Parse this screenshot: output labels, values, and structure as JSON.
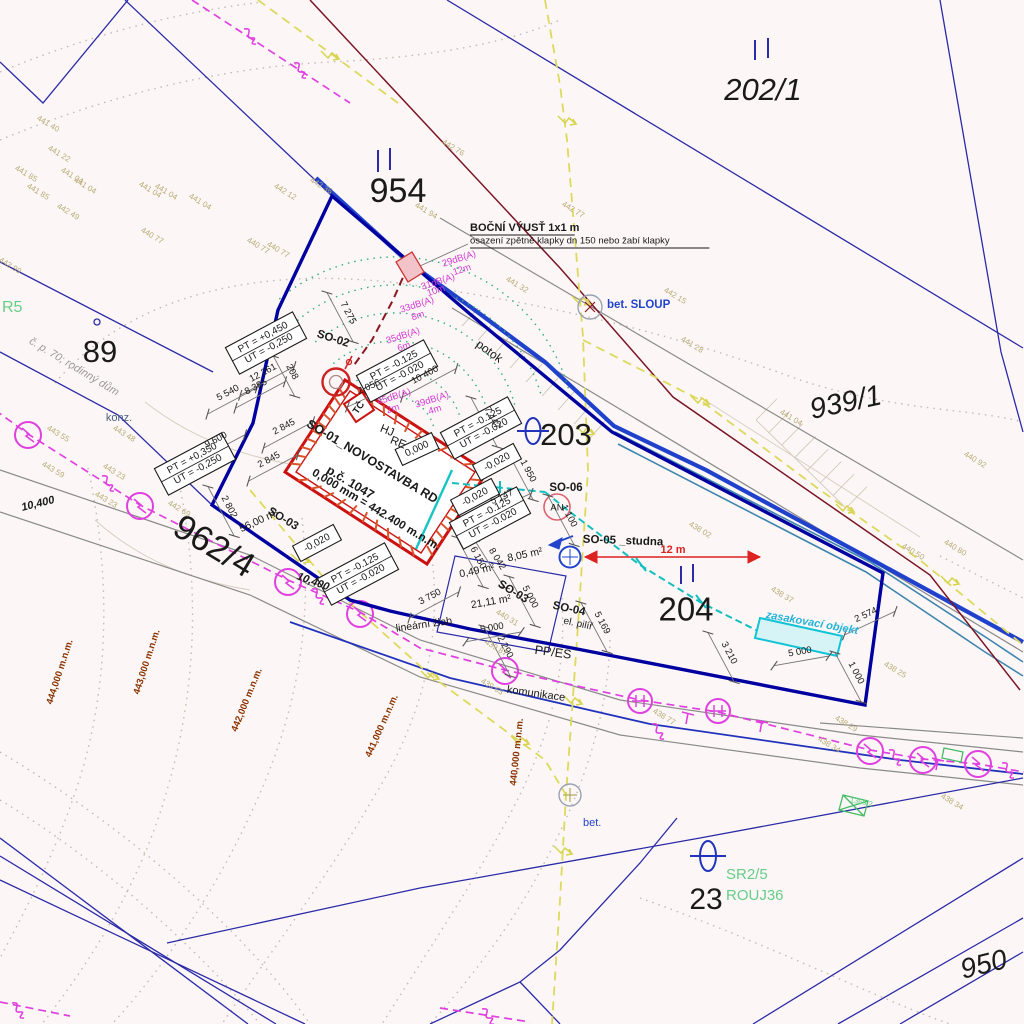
{
  "title": "Situační výkres – novostavba RD (koordinační situace)",
  "colors": {
    "background": "#fcf7f6",
    "parcel_line": "#2b2ba8",
    "site_boundary": "#0000a0",
    "stream": "#1f41cc",
    "building_red": "#cc1111",
    "hatch_orange": "#d9542b",
    "utility_magenta": "#e040e0",
    "gas_yellow": "#ddd95c",
    "pipe_cyan": "#11bfbf",
    "noise_magenta": "#d23bd2",
    "elevation_tan": "#b7ab76",
    "contour_brown": "#8a3300",
    "green_label": "#66cc88",
    "road_gray": "#8a8a8a",
    "dim_red": "#dd2222",
    "label_blue": "#2244cc"
  },
  "labels": [
    {
      "t": "954",
      "x": 398,
      "y": 193,
      "s": 34
    },
    {
      "t": "202/1",
      "x": 763,
      "y": 92,
      "s": 31,
      "i": 1
    },
    {
      "t": "939/1",
      "x": 846,
      "y": 404,
      "s": 29,
      "i": 1,
      "r": -12
    },
    {
      "t": "89",
      "x": 100,
      "y": 354,
      "s": 31
    },
    {
      "t": "203",
      "x": 566,
      "y": 437,
      "s": 31
    },
    {
      "t": "962/4",
      "x": 213,
      "y": 548,
      "s": 35,
      "r": 31
    },
    {
      "t": "204",
      "x": 686,
      "y": 612,
      "s": 33
    },
    {
      "t": "23",
      "x": 706,
      "y": 901,
      "s": 30
    },
    {
      "t": "950",
      "x": 984,
      "y": 966,
      "s": 28,
      "r": -14,
      "i": 1
    },
    {
      "t": "SO-01_NOVOSTAVBA RD",
      "x": 372,
      "y": 462,
      "r": 31,
      "s": 12.5,
      "b": 1
    },
    {
      "t": "p.č. 1047",
      "x": 350,
      "y": 483,
      "r": 31,
      "s": 12.5,
      "b": 1
    },
    {
      "t": "0,000 mm = 442.400 m.n.m.",
      "x": 376,
      "y": 510,
      "r": 31,
      "s": 11.5,
      "b": 1
    },
    {
      "t": "SO-02",
      "x": 333,
      "y": 339,
      "r": 18,
      "s": 11.5,
      "b": 1
    },
    {
      "t": "SO-03",
      "x": 283,
      "y": 519,
      "r": 31,
      "s": 11.5,
      "b": 1
    },
    {
      "t": "SO-03",
      "x": 513,
      "y": 592,
      "r": 31,
      "s": 11.5,
      "b": 1
    },
    {
      "t": "SO-04",
      "x": 569,
      "y": 609,
      "r": 12,
      "s": 11.5,
      "b": 1
    },
    {
      "t": "el. pilíř",
      "x": 578,
      "y": 624,
      "r": 12,
      "s": 10
    },
    {
      "t": "PP/ES",
      "x": 553,
      "y": 653,
      "r": 8,
      "s": 12.5
    },
    {
      "t": "SO-05 _studna",
      "x": 623,
      "y": 541,
      "r": 2,
      "s": 11.5,
      "b": 1
    },
    {
      "t": "SO-06",
      "x": 566,
      "y": 488,
      "s": 11.5,
      "b": 1
    },
    {
      "t": "AN",
      "x": 557,
      "y": 508,
      "s": 9.5
    },
    {
      "t": "HJ",
      "x": 387,
      "y": 431,
      "r": 22,
      "s": 11.5
    },
    {
      "t": "RE",
      "x": 398,
      "y": 443,
      "r": 22,
      "s": 11.5
    },
    {
      "t": "TČ",
      "x": 359,
      "y": 408,
      "r": -55,
      "s": 9.5,
      "b": 1
    },
    {
      "t": "potok",
      "x": 489,
      "y": 352,
      "r": 36,
      "s": 12
    },
    {
      "t": "12 261",
      "x": 263,
      "y": 373,
      "r": -28,
      "dim": 1
    },
    {
      "t": "8 385",
      "x": 256,
      "y": 387,
      "r": -28,
      "dim": 1
    },
    {
      "t": "5 540",
      "x": 228,
      "y": 393,
      "r": -28,
      "dim": 1
    },
    {
      "t": "9 600",
      "x": 216,
      "y": 440,
      "r": -28,
      "dim": 1
    },
    {
      "t": "2 845",
      "x": 284,
      "y": 427,
      "r": -28,
      "dim": 1
    },
    {
      "t": "2 845",
      "x": 269,
      "y": 460,
      "r": -28,
      "dim": 1
    },
    {
      "t": "208",
      "x": 292,
      "y": 372,
      "r": 62,
      "dim": 1
    },
    {
      "t": "2 802",
      "x": 229,
      "y": 507,
      "r": 62,
      "dim": 1
    },
    {
      "t": "7 275",
      "x": 348,
      "y": 313,
      "r": 62,
      "dim": 1
    },
    {
      "t": "2 056",
      "x": 369,
      "y": 387,
      "r": -25,
      "dim": 1
    },
    {
      "t": "10 400",
      "x": 425,
      "y": 375,
      "r": -28,
      "dim": 1
    },
    {
      "t": "7 447",
      "x": 492,
      "y": 418,
      "r": 62,
      "dim": 1
    },
    {
      "t": "1 950",
      "x": 528,
      "y": 471,
      "r": 62,
      "dim": 1
    },
    {
      "t": "5 147",
      "x": 502,
      "y": 497,
      "r": -25,
      "dim": 1
    },
    {
      "t": "6 150",
      "x": 478,
      "y": 558,
      "r": 62,
      "dim": 1
    },
    {
      "t": "8 042",
      "x": 497,
      "y": 559,
      "r": 58,
      "dim": 1
    },
    {
      "t": "3 750",
      "x": 430,
      "y": 597,
      "r": -28,
      "dim": 1
    },
    {
      "t": "5 000",
      "x": 492,
      "y": 628,
      "r": -10,
      "dim": 1
    },
    {
      "t": "5 000",
      "x": 530,
      "y": 597,
      "r": 62,
      "dim": 1
    },
    {
      "t": "2 290",
      "x": 505,
      "y": 647,
      "r": 62,
      "dim": 1
    },
    {
      "t": "5 169",
      "x": 602,
      "y": 623,
      "r": 62,
      "dim": 1
    },
    {
      "t": "1 100",
      "x": 569,
      "y": 516,
      "r": 62,
      "dim": 1
    },
    {
      "t": "3 210",
      "x": 729,
      "y": 653,
      "r": 62,
      "dim": 1
    },
    {
      "t": "5 000",
      "x": 800,
      "y": 652,
      "r": -10,
      "dim": 1
    },
    {
      "t": "2 574",
      "x": 866,
      "y": 615,
      "r": -25,
      "dim": 1
    },
    {
      "t": "1 000",
      "x": 856,
      "y": 673,
      "r": 62,
      "dim": 1
    },
    {
      "t": "56,00 m²",
      "x": 259,
      "y": 521,
      "r": -25,
      "s": 10.5
    },
    {
      "t": "8,05 m²",
      "x": 525,
      "y": 555,
      "r": -12,
      "s": 10.5
    },
    {
      "t": "0,49 m²",
      "x": 477,
      "y": 571,
      "r": -12,
      "s": 10.5
    },
    {
      "t": "21,11 m²",
      "x": 491,
      "y": 602,
      "r": -10,
      "s": 10.5
    },
    {
      "t": "12 m",
      "x": 673,
      "y": 550,
      "s": 11,
      "b": 1,
      "c": "#dd2222"
    },
    {
      "t": "10,400",
      "x": 38,
      "y": 504,
      "r": -14,
      "s": 11,
      "b": 1,
      "i": 1
    },
    {
      "t": "10,400",
      "x": 313,
      "y": 582,
      "r": 20,
      "s": 11,
      "b": 1,
      "i": 1
    },
    {
      "t": "lineární žlab",
      "x": 424,
      "y": 625,
      "r": -8,
      "s": 10.5
    },
    {
      "t": "komunikace",
      "x": 536,
      "y": 694,
      "r": 8,
      "s": 11
    },
    {
      "t": "konz.",
      "x": 119,
      "y": 418,
      "s": 11,
      "c": "#4a6080"
    },
    {
      "t": "č. p. 70; rodinný dům",
      "x": 74,
      "y": 367,
      "r": 31,
      "s": 11,
      "c": "#999999",
      "i": 1
    },
    {
      "t": "BOČNÍ VÝUSŤ 1x1 m",
      "x": 470,
      "y": 228,
      "s": 11,
      "b": 1,
      "a": "start",
      "u": 1
    },
    {
      "t": "osazení zpětné klapky dn 150 nebo žabí klapky",
      "x": 470,
      "y": 241,
      "s": 9.5,
      "a": "start",
      "u": 1
    },
    {
      "t": "bet. SLOUP",
      "x": 607,
      "y": 305,
      "s": 11.5,
      "c": "#2244cc",
      "a": "start",
      "b": 1
    },
    {
      "t": "bet.",
      "x": 583,
      "y": 823,
      "s": 11,
      "c": "#2244cc",
      "a": "start"
    },
    {
      "t": "zasakovací objekt",
      "x": 766,
      "y": 615,
      "r": 10,
      "s": 11,
      "c": "#22b3d9",
      "b": 1,
      "i": 1,
      "a": "start"
    },
    {
      "t": "R5",
      "x": 2,
      "y": 308,
      "s": 16,
      "c": "#66cc88",
      "a": "start"
    },
    {
      "t": "SR2/5",
      "x": 726,
      "y": 875,
      "s": 15,
      "c": "#66cc88",
      "a": "start"
    },
    {
      "t": "ROUJ36",
      "x": 726,
      "y": 896,
      "s": 15,
      "c": "#66cc88",
      "a": "start"
    },
    {
      "t": "1369 2",
      "x": 850,
      "y": 800,
      "r": 12,
      "s": 7.5,
      "c": "#66cc88",
      "a": "start"
    },
    {
      "t": "29dB(A)",
      "x": 459,
      "y": 259,
      "r": -18,
      "s": 9.5,
      "c": "#d23bd2"
    },
    {
      "t": "12m",
      "x": 462,
      "y": 270,
      "r": -18,
      "s": 9.5,
      "c": "#d23bd2"
    },
    {
      "t": "31dB(A)",
      "x": 438,
      "y": 282,
      "r": -18,
      "s": 9.5,
      "c": "#d23bd2"
    },
    {
      "t": "10m",
      "x": 436,
      "y": 291,
      "r": -18,
      "s": 9.5,
      "c": "#d23bd2"
    },
    {
      "t": "33dB(A)",
      "x": 417,
      "y": 305,
      "r": -18,
      "s": 9.5,
      "c": "#d23bd2"
    },
    {
      "t": "8m",
      "x": 418,
      "y": 316,
      "r": -18,
      "s": 9.5,
      "c": "#d23bd2"
    },
    {
      "t": "35dB(A)",
      "x": 403,
      "y": 336,
      "r": -18,
      "s": 9.5,
      "c": "#d23bd2"
    },
    {
      "t": "6m",
      "x": 404,
      "y": 347,
      "r": -18,
      "s": 9.5,
      "c": "#d23bd2"
    },
    {
      "t": "39dB(A)",
      "x": 432,
      "y": 400,
      "r": -18,
      "s": 9.5,
      "c": "#d23bd2"
    },
    {
      "t": "4m",
      "x": 435,
      "y": 410,
      "r": -18,
      "s": 9.5,
      "c": "#d23bd2"
    },
    {
      "t": "45dB(A)",
      "x": 394,
      "y": 397,
      "r": -18,
      "s": 9.5,
      "c": "#d23bd2"
    },
    {
      "t": "2m",
      "x": 393,
      "y": 409,
      "r": -18,
      "s": 9.5,
      "c": "#d23bd2"
    },
    {
      "t": "441 40",
      "x": 48,
      "y": 124,
      "r": 31,
      "s": 8,
      "c": "#b7ab76"
    },
    {
      "t": "441 22",
      "x": 59,
      "y": 154,
      "r": 31,
      "s": 8,
      "c": "#b7ab76"
    },
    {
      "t": "441 85",
      "x": 26,
      "y": 174,
      "r": 31,
      "s": 8,
      "c": "#b7ab76"
    },
    {
      "t": "441 04",
      "x": 72,
      "y": 176,
      "r": 31,
      "s": 8,
      "c": "#b7ab76"
    },
    {
      "t": "441 85",
      "x": 38,
      "y": 192,
      "r": 31,
      "s": 8,
      "c": "#b7ab76"
    },
    {
      "t": "441 04",
      "x": 85,
      "y": 186,
      "r": 31,
      "s": 8,
      "c": "#b7ab76"
    },
    {
      "t": "441 04",
      "x": 150,
      "y": 190,
      "r": 31,
      "s": 8,
      "c": "#b7ab76"
    },
    {
      "t": "441 04",
      "x": 166,
      "y": 192,
      "r": 31,
      "s": 8,
      "c": "#b7ab76"
    },
    {
      "t": "441 04",
      "x": 200,
      "y": 202,
      "r": 31,
      "s": 8,
      "c": "#b7ab76"
    },
    {
      "t": "442 49",
      "x": 68,
      "y": 212,
      "r": 31,
      "s": 8,
      "c": "#b7ab76"
    },
    {
      "t": "440 77",
      "x": 152,
      "y": 236,
      "r": 31,
      "s": 8,
      "c": "#b7ab76"
    },
    {
      "t": "440 77",
      "x": 258,
      "y": 246,
      "r": 31,
      "s": 8,
      "c": "#b7ab76"
    },
    {
      "t": "440 77",
      "x": 278,
      "y": 250,
      "r": 31,
      "s": 8,
      "c": "#b7ab76"
    },
    {
      "t": "442 12",
      "x": 285,
      "y": 192,
      "r": 31,
      "s": 8,
      "c": "#b7ab76"
    },
    {
      "t": "442 36",
      "x": 321,
      "y": 186,
      "r": 31,
      "s": 8,
      "c": "#b7ab76"
    },
    {
      "t": "443 99",
      "x": 10,
      "y": 266,
      "r": 31,
      "s": 8,
      "c": "#b7ab76"
    },
    {
      "t": "441 94",
      "x": 426,
      "y": 211,
      "r": 31,
      "s": 8,
      "c": "#b7ab76"
    },
    {
      "t": "442 76",
      "x": 453,
      "y": 148,
      "r": 31,
      "s": 8,
      "c": "#b7ab76"
    },
    {
      "t": "442 77",
      "x": 573,
      "y": 210,
      "r": 31,
      "s": 8,
      "c": "#b7ab76"
    },
    {
      "t": "441 32",
      "x": 517,
      "y": 285,
      "r": 31,
      "s": 8,
      "c": "#b7ab76"
    },
    {
      "t": "442 15",
      "x": 675,
      "y": 296,
      "r": 31,
      "s": 8,
      "c": "#b7ab76"
    },
    {
      "t": "441 28",
      "x": 692,
      "y": 345,
      "r": 31,
      "s": 8,
      "c": "#b7ab76"
    },
    {
      "t": "441 04",
      "x": 791,
      "y": 418,
      "r": 31,
      "s": 8,
      "c": "#b7ab76"
    },
    {
      "t": "440 92",
      "x": 975,
      "y": 460,
      "r": 31,
      "s": 8,
      "c": "#b7ab76"
    },
    {
      "t": "440 50",
      "x": 913,
      "y": 552,
      "r": 31,
      "s": 8,
      "c": "#b7ab76"
    },
    {
      "t": "440 80",
      "x": 955,
      "y": 548,
      "r": 31,
      "s": 8,
      "c": "#b7ab76"
    },
    {
      "t": "438 02",
      "x": 700,
      "y": 530,
      "r": 31,
      "s": 8,
      "c": "#b7ab76"
    },
    {
      "t": "438 37",
      "x": 782,
      "y": 595,
      "r": 31,
      "s": 8,
      "c": "#b7ab76"
    },
    {
      "t": "438 25",
      "x": 895,
      "y": 670,
      "r": 31,
      "s": 8,
      "c": "#b7ab76"
    },
    {
      "t": "438 29",
      "x": 846,
      "y": 724,
      "r": 31,
      "s": 8,
      "c": "#b7ab76"
    },
    {
      "t": "438 34",
      "x": 829,
      "y": 745,
      "r": 31,
      "s": 8,
      "c": "#b7ab76"
    },
    {
      "t": "438 34",
      "x": 952,
      "y": 802,
      "r": 31,
      "s": 8,
      "c": "#b7ab76"
    },
    {
      "t": "440 31",
      "x": 507,
      "y": 618,
      "r": 31,
      "s": 8,
      "c": "#b7ab76"
    },
    {
      "t": "439 87",
      "x": 496,
      "y": 648,
      "r": 31,
      "s": 8,
      "c": "#b7ab76"
    },
    {
      "t": "439 63",
      "x": 492,
      "y": 687,
      "r": 31,
      "s": 8,
      "c": "#b7ab76"
    },
    {
      "t": "438 77",
      "x": 664,
      "y": 717,
      "r": 31,
      "s": 8,
      "c": "#b7ab76"
    },
    {
      "t": "443 55",
      "x": 58,
      "y": 434,
      "r": 31,
      "s": 8,
      "c": "#b7ab76"
    },
    {
      "t": "443 48",
      "x": 124,
      "y": 434,
      "r": 31,
      "s": 8,
      "c": "#b7ab76"
    },
    {
      "t": "443 59",
      "x": 53,
      "y": 470,
      "r": 31,
      "s": 8,
      "c": "#b7ab76"
    },
    {
      "t": "443 23",
      "x": 114,
      "y": 472,
      "r": 31,
      "s": 8,
      "c": "#b7ab76"
    },
    {
      "t": "443 23",
      "x": 106,
      "y": 500,
      "r": 31,
      "s": 8,
      "c": "#b7ab76"
    },
    {
      "t": "442 69",
      "x": 179,
      "y": 509,
      "r": 31,
      "s": 8,
      "c": "#b7ab76"
    },
    {
      "t": "444,000 m.n.m.",
      "x": 60,
      "y": 672,
      "r": -72,
      "s": 9.5,
      "b": 1,
      "c": "#8a3300"
    },
    {
      "t": "443,000 m.n.m.",
      "x": 147,
      "y": 662,
      "r": -72,
      "s": 9.5,
      "b": 1,
      "c": "#8a3300"
    },
    {
      "t": "442,000 m.n.m.",
      "x": 247,
      "y": 700,
      "r": -68,
      "s": 9.5,
      "b": 1,
      "c": "#8a3300"
    },
    {
      "t": "441,000 m.n.m.",
      "x": 382,
      "y": 726,
      "r": -66,
      "s": 9.5,
      "b": 1,
      "c": "#8a3300"
    },
    {
      "t": "440,000 m.n.m.",
      "x": 517,
      "y": 752,
      "r": -84,
      "s": 9.5,
      "b": 1,
      "c": "#8a3300"
    }
  ],
  "boxes": [
    {
      "lines": [
        "PT = +0,450",
        "UT = -0,250"
      ],
      "x": 266,
      "y": 343,
      "r": -28
    },
    {
      "lines": [
        "PT = +0,350",
        "UT = -0,250"
      ],
      "x": 195,
      "y": 464,
      "r": -28
    },
    {
      "lines": [
        "PT = -0.125",
        "UT = -0.020"
      ],
      "x": 397,
      "y": 371,
      "r": -28
    },
    {
      "lines": [
        "PT = -0.125",
        "UT = -0.020"
      ],
      "x": 481,
      "y": 428,
      "r": -28
    },
    {
      "lines": [
        "PT = -0.125",
        "UT = -0.020"
      ],
      "x": 490,
      "y": 518,
      "r": -28
    },
    {
      "lines": [
        "PT = -0.125",
        "UT = -0.020"
      ],
      "x": 358,
      "y": 574,
      "r": -28
    },
    {
      "lines": [
        "-0,020"
      ],
      "x": 317,
      "y": 543,
      "r": -28
    },
    {
      "lines": [
        "0,000"
      ],
      "x": 417,
      "y": 449,
      "r": -25
    },
    {
      "lines": [
        "-0,020"
      ],
      "x": 497,
      "y": 462,
      "r": -28
    },
    {
      "lines": [
        "-0,020"
      ],
      "x": 475,
      "y": 497,
      "r": -28
    }
  ]
}
